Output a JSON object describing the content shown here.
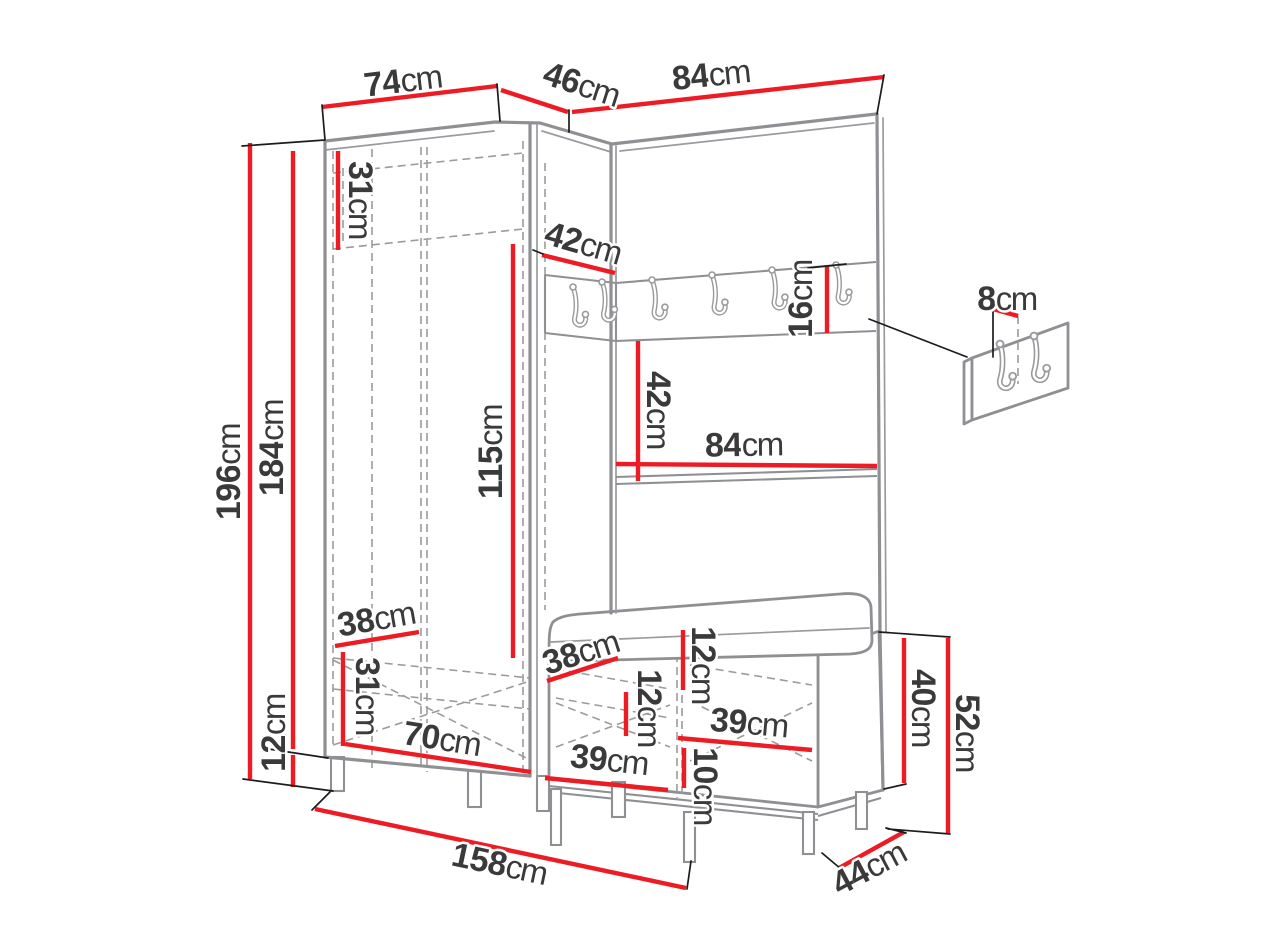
{
  "units": {
    "cm": "cm"
  },
  "colors": {
    "dimension_line": "#ed1c24",
    "furniture_outline": "#8f9094",
    "label_text": "#3a3a3b",
    "background": "#ffffff"
  },
  "dimensions": {
    "left_section_width": {
      "value": "74"
    },
    "corner_section_width": {
      "value": "46"
    },
    "right_section_width": {
      "value": "84"
    },
    "total_height": {
      "value": "196"
    },
    "body_height": {
      "value": "184"
    },
    "left_leg_height": {
      "value": "12"
    },
    "top_shelf_height": {
      "value": "31"
    },
    "corner_inner_depth": {
      "value": "42"
    },
    "hook_rail_height": {
      "value": "16"
    },
    "niche_height": {
      "value": "42"
    },
    "niche_width": {
      "value": "84"
    },
    "hanging_space_height": {
      "value": "115"
    },
    "wardrobe_inner_depth": {
      "value": "38"
    },
    "bottom_compartment_height": {
      "value": "31"
    },
    "wardrobe_inner_width": {
      "value": "70"
    },
    "bench_inner_depth": {
      "value": "38"
    },
    "seat_cushion_height": {
      "value": "12"
    },
    "bench_shelf_spacing": {
      "value": "12"
    },
    "bench_inner_width_upper": {
      "value": "39"
    },
    "bench_bottom_clearance": {
      "value": "10"
    },
    "bench_inner_width_lower": {
      "value": "39"
    },
    "bench_body_height": {
      "value": "40"
    },
    "bench_total_height": {
      "value": "52"
    },
    "total_width": {
      "value": "158"
    },
    "bench_depth": {
      "value": "44"
    },
    "hook_plate_width": {
      "value": "8"
    }
  }
}
